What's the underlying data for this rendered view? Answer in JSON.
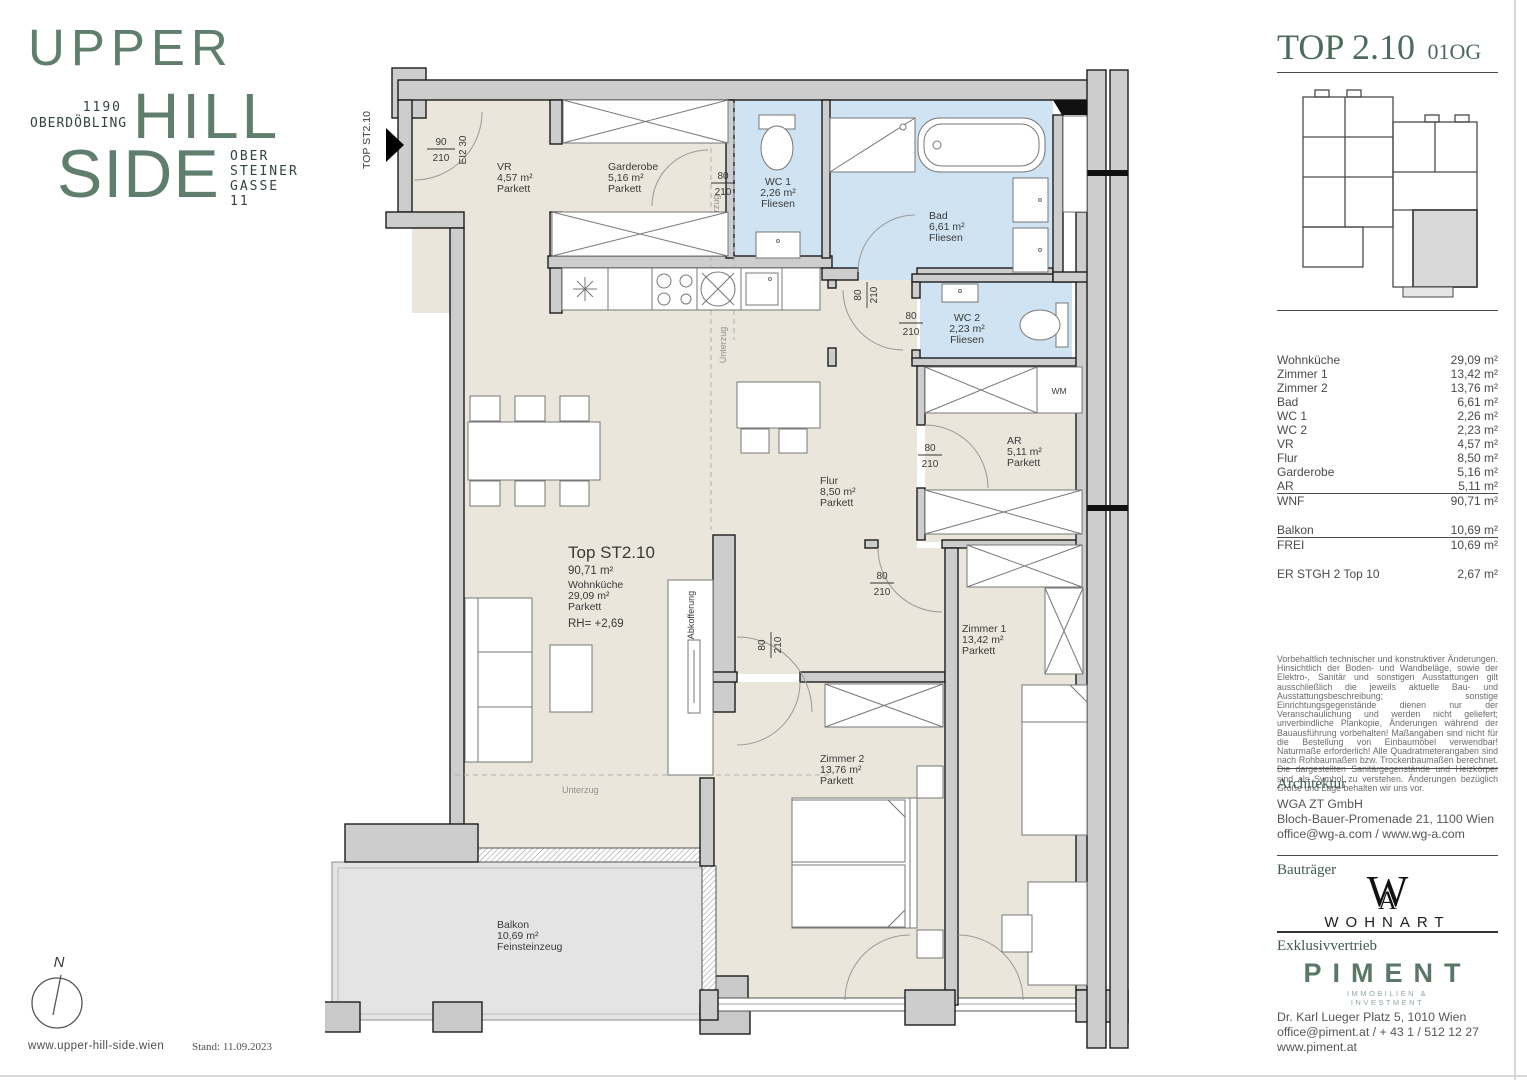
{
  "brand": {
    "word1": "UPPER",
    "word2": "HILL",
    "word3": "SIDE",
    "zip": "1190",
    "district": "OBERDÖBLING",
    "street_l1": "OBER",
    "street_l2": "STEINER",
    "street_l3": "GASSE",
    "street_l4": "11",
    "website": "www.upper-hill-side.wien"
  },
  "meta": {
    "stand": "Stand: 11.09.2023",
    "north": "N"
  },
  "header": {
    "title": "TOP 2.10",
    "floor": "01OG"
  },
  "plan": {
    "unit_rotated": "TOP ST2.10",
    "entrance": {
      "w": "90",
      "h": "210",
      "fire": "EI2 30"
    },
    "door": {
      "w": "80",
      "h": "210"
    },
    "beam": "Unterzug",
    "boxing": "Abkofferung",
    "wm": "WM",
    "center": {
      "title": "Top ST2.10",
      "total": "90,71 m²",
      "room": "Wohnküche",
      "area": "29,09 m²",
      "finish": "Parkett",
      "height": "RH= +2,69"
    },
    "rooms": {
      "vr": {
        "name": "VR",
        "area": "4,57 m²",
        "finish": "Parkett"
      },
      "garderobe": {
        "name": "Garderobe",
        "area": "5,16 m²",
        "finish": "Parkett"
      },
      "wc1": {
        "name": "WC 1",
        "area": "2,26 m²",
        "finish": "Fliesen"
      },
      "bad": {
        "name": "Bad",
        "area": "6,61 m²",
        "finish": "Fliesen"
      },
      "wc2": {
        "name": "WC 2",
        "area": "2,23 m²",
        "finish": "Fliesen"
      },
      "ar": {
        "name": "AR",
        "area": "5,11 m²",
        "finish": "Parkett"
      },
      "flur": {
        "name": "Flur",
        "area": "8,50 m²",
        "finish": "Parkett"
      },
      "z1": {
        "name": "Zimmer 1",
        "area": "13,42 m²",
        "finish": "Parkett"
      },
      "z2": {
        "name": "Zimmer 2",
        "area": "13,76 m²",
        "finish": "Parkett"
      },
      "balkon": {
        "name": "Balkon",
        "area": "10,69 m²",
        "finish": "Feinsteinzeug"
      }
    }
  },
  "area_table": {
    "rows": [
      {
        "label": "Wohnküche",
        "value": "29,09 m²"
      },
      {
        "label": "Zimmer 1",
        "value": "13,42 m²"
      },
      {
        "label": "Zimmer 2",
        "value": "13,76 m²"
      },
      {
        "label": "Bad",
        "value": "6,61 m²"
      },
      {
        "label": "WC 1",
        "value": "2,26 m²"
      },
      {
        "label": "WC 2",
        "value": "2,23 m²"
      },
      {
        "label": "VR",
        "value": "4,57 m²"
      },
      {
        "label": "Flur",
        "value": "8,50 m²"
      },
      {
        "label": "Garderobe",
        "value": "5,16 m²"
      },
      {
        "label": "AR",
        "value": "5,11 m²"
      }
    ],
    "wnf": {
      "label": "WNF",
      "value": "90,71 m²"
    },
    "balkon": {
      "label": "Balkon",
      "value": "10,69 m²"
    },
    "frei": {
      "label": "FREI",
      "value": "10,69 m²"
    },
    "er": {
      "label": "ER STGH 2 Top 10",
      "value": "2,67 m²"
    }
  },
  "legal": "Vorbehaltlich technischer und konstruktiver Änderungen. Hinsichtlich der Boden- und Wandbeläge, sowie der Elektro-, Sanitär und sonstigen Ausstattungen gilt ausschließlich die jeweils aktuelle Bau- und Ausstattungsbeschreibung; sonstige Einrichtungsgegenstände dienen nur der Veranschaulichung und werden nicht geliefert; unverbindliche Plankopie, Änderungen während der Bauausführung vorbehalten! Maßangaben sind nicht für die Bestellung von Einbaumöbel verwendbar! Naturmaße erforderlich! Alle Quadratmeterangaben sind nach Rohbaumaßen bzw. Trockenbaumaßen berechnet. Die dargestellten Sanitärgegenstände und Heizkörper sind als Symbol zu verstehen. Änderungen bezüglich Größe und Lage behalten wir uns vor.",
  "architecture": {
    "heading": "Architektur",
    "company": "WGA ZT GmbH",
    "address": "Bloch-Bauer-Promenade 21, 1100 Wien",
    "contact": "office@wg-a.com / www.wg-a.com"
  },
  "developer": {
    "heading": "Bauträger",
    "mark": "W",
    "mark2": "A",
    "name": "WOHNART"
  },
  "sales": {
    "heading": "Exklusivvertrieb",
    "logo": "PIMENT",
    "tagline": "IMMOBILIEN &\nINVESTMENT",
    "address": "Dr. Karl Lueger Platz 5, 1010 Wien",
    "contact": "office@piment.at / + 43 1 / 512 12 27",
    "web": "www.piment.at"
  },
  "colors": {
    "brand_green": "#5f7e6d",
    "heading_green": "#4c6b5b",
    "floor_beige": "#eae6db",
    "wet_blue": "#cfe3f2",
    "wall_gray": "#cdcdcd",
    "balcony_gray": "#e4e4e4"
  }
}
